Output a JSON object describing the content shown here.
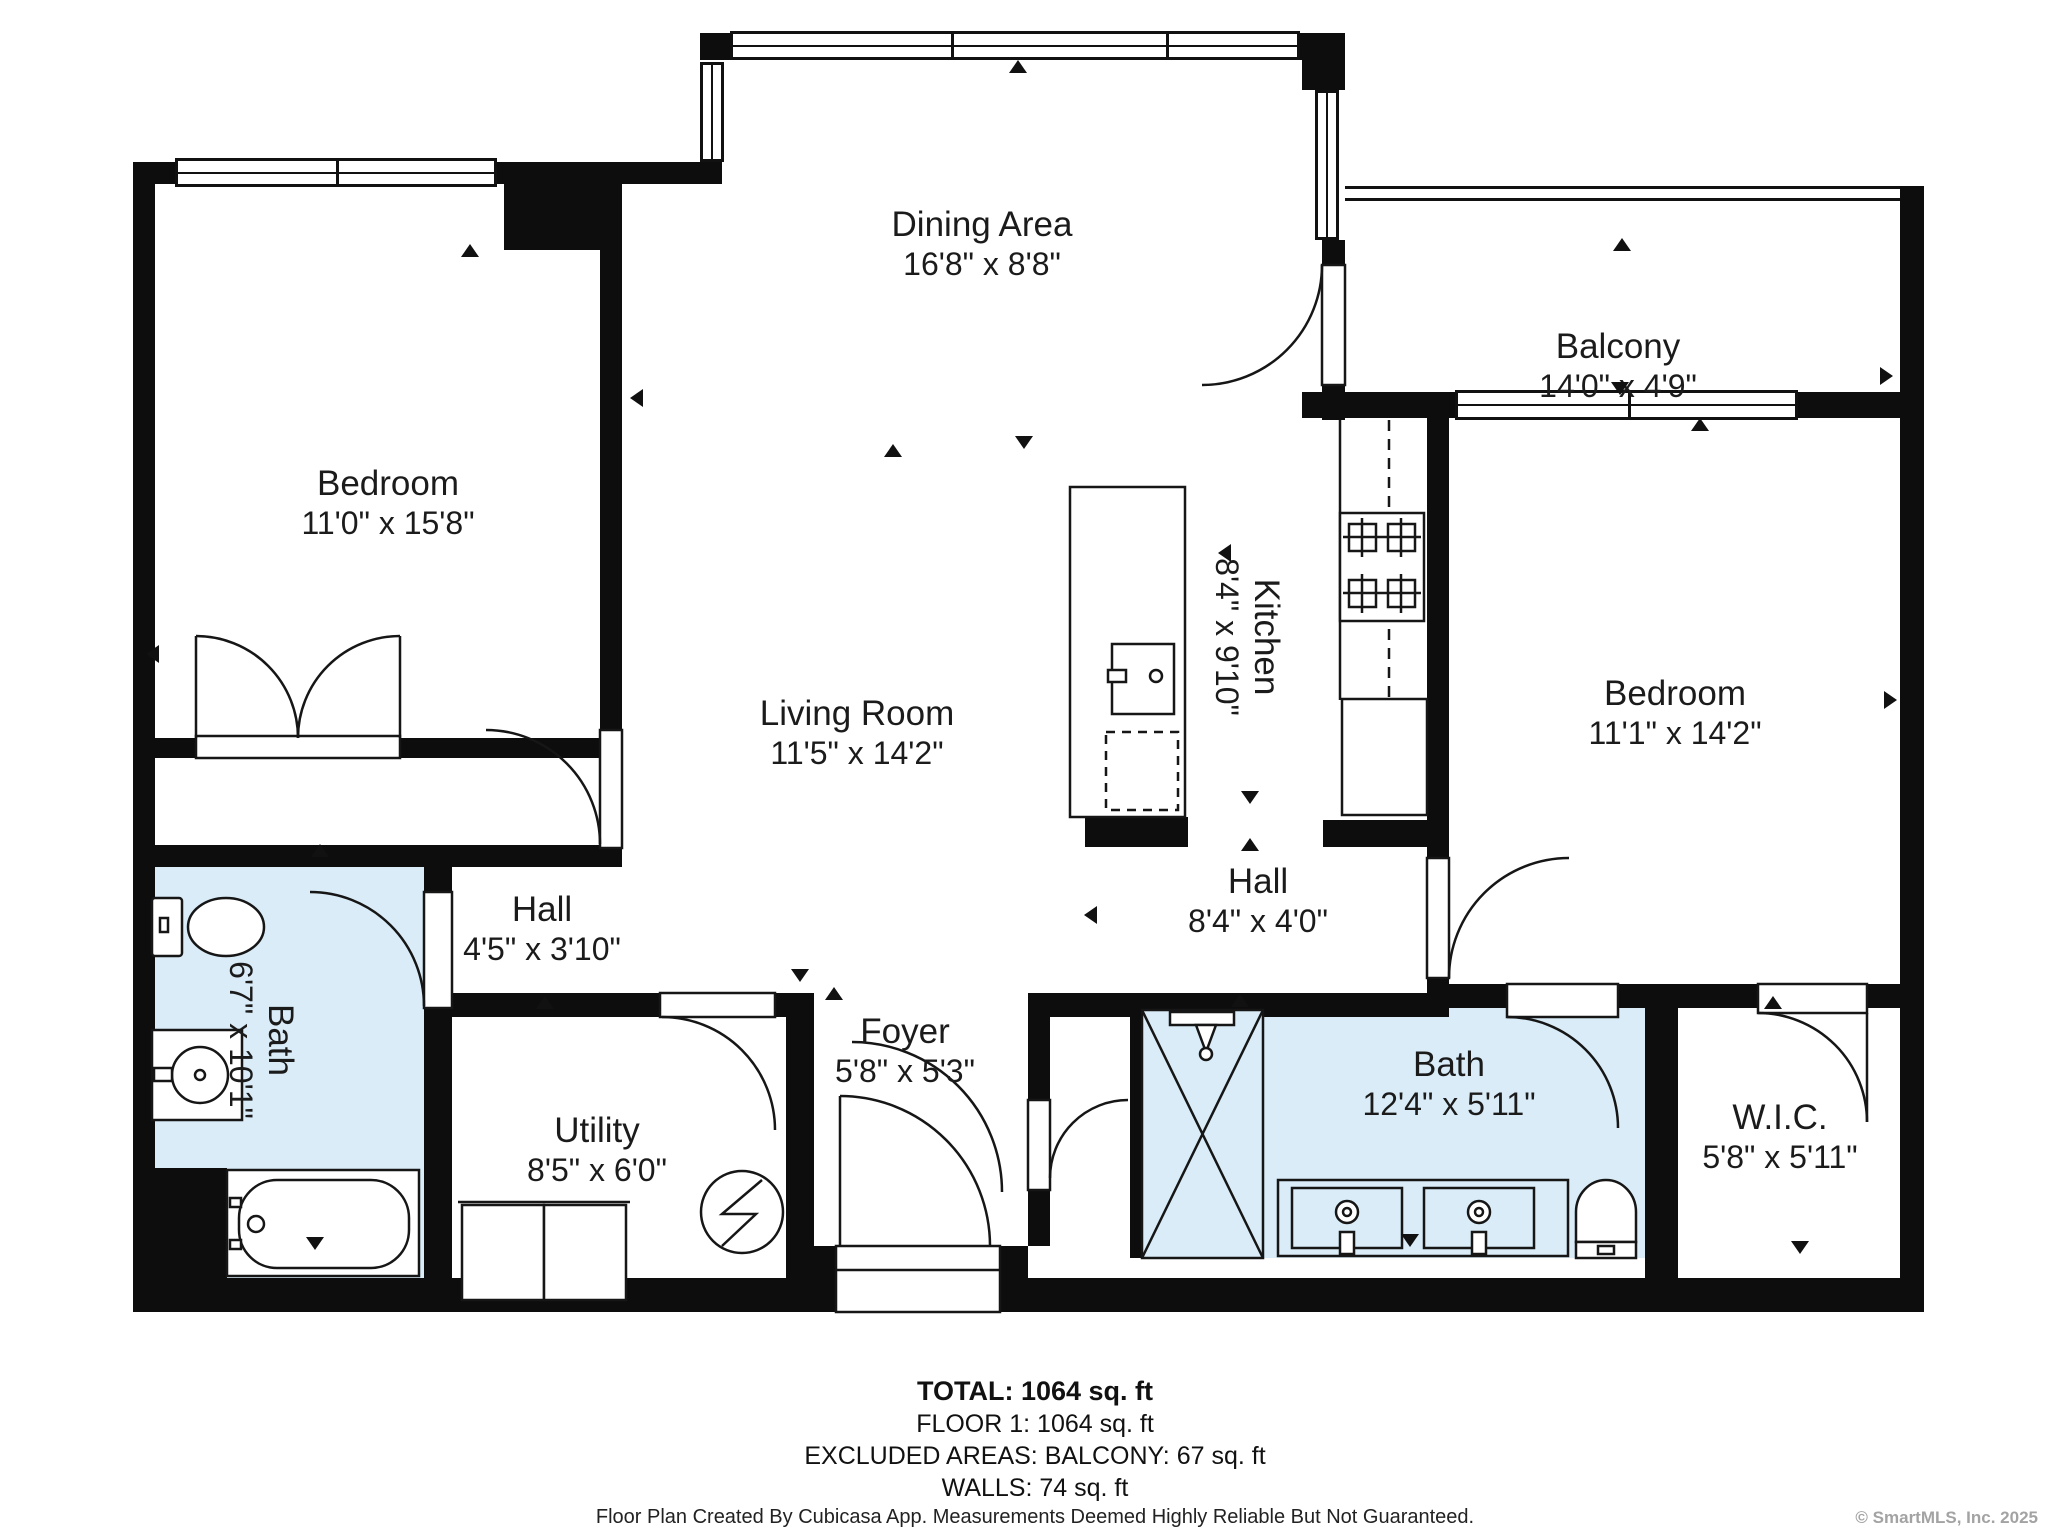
{
  "rooms": [
    {
      "name": "Bedroom",
      "dims": "11'0\" x 15'8\""
    },
    {
      "name": "Dining Area",
      "dims": "16'8\" x 8'8\""
    },
    {
      "name": "Balcony",
      "dims": "14'0\" x 4'9\""
    },
    {
      "name": "Living Room",
      "dims": "11'5\" x 14'2\""
    },
    {
      "name": "Kitchen",
      "dims": "8'4\" x 9'10\""
    },
    {
      "name": "Bedroom",
      "dims": "11'1\" x 14'2\""
    },
    {
      "name": "Hall",
      "dims": "4'5\" x 3'10\""
    },
    {
      "name": "Hall",
      "dims": "8'4\" x 4'0\""
    },
    {
      "name": "Bath",
      "dims": "6'7\" x 10'1\""
    },
    {
      "name": "Utility",
      "dims": "8'5\" x 6'0\""
    },
    {
      "name": "Foyer",
      "dims": "5'8\" x 5'3\""
    },
    {
      "name": "Bath",
      "dims": "12'4\" x 5'11\""
    },
    {
      "name": "W.I.C.",
      "dims": "5'8\" x 5'11\""
    }
  ],
  "summary": {
    "total": "TOTAL: 1064 sq. ft",
    "floor": "FLOOR 1: 1064 sq. ft",
    "excluded": "EXCLUDED AREAS: BALCONY: 67 sq. ft",
    "walls": "WALLS: 74 sq. ft"
  },
  "disclaimer": "Floor Plan Created By Cubicasa App. Measurements Deemed Highly Reliable But Not Guaranteed.",
  "copyright": "© SmartMLS, Inc. 2025",
  "colors": {
    "wall": "#0d0d0d",
    "bath_fill": "#d9ecf8",
    "label": "#1b1b1b",
    "copyright_gray": "#a3a3a3"
  },
  "icons": {
    "direction_arrow": "triangle",
    "door_swing": "quarter-arc"
  }
}
